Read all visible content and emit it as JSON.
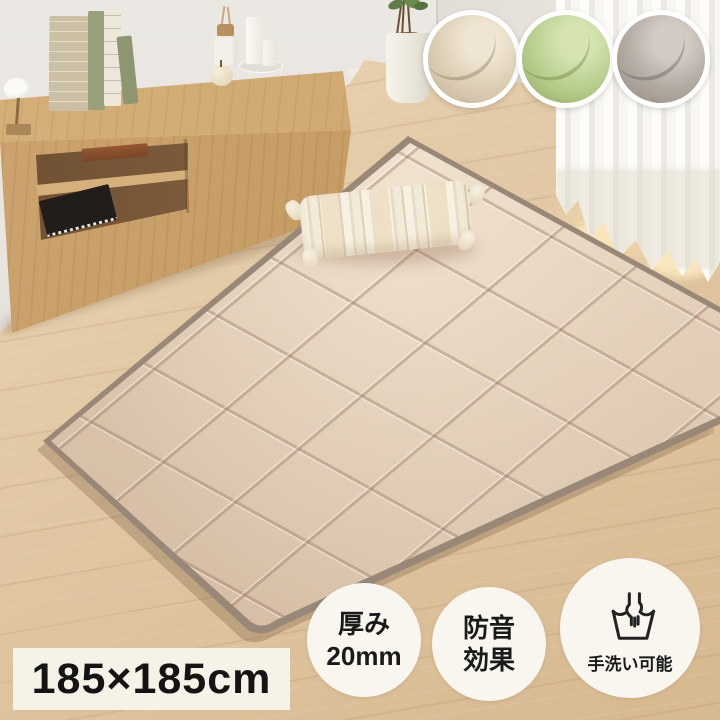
{
  "size_label": {
    "text": "185×185cm"
  },
  "badges": {
    "thickness": {
      "line1": "厚み",
      "line2": "20mm"
    },
    "soundproof": {
      "line1": "防音",
      "line2": "効果"
    },
    "handwash": {
      "label": "手洗い可能"
    }
  },
  "swatches": [
    {
      "name": "beige",
      "color": "#ddcfb6"
    },
    {
      "name": "green",
      "color": "#b8cf8e"
    },
    {
      "name": "gray",
      "color": "#b4aba3"
    }
  ],
  "colors": {
    "rug_base": "#dec8b1",
    "rug_trim": "#998878",
    "floor_wood": "#e0c6a2",
    "wall": "#ebe8e3",
    "cabinet_wood": "#c79e68",
    "badge_bg": "#f9f6ef",
    "label_bg": "#f8f4eb",
    "text": "#141414"
  }
}
